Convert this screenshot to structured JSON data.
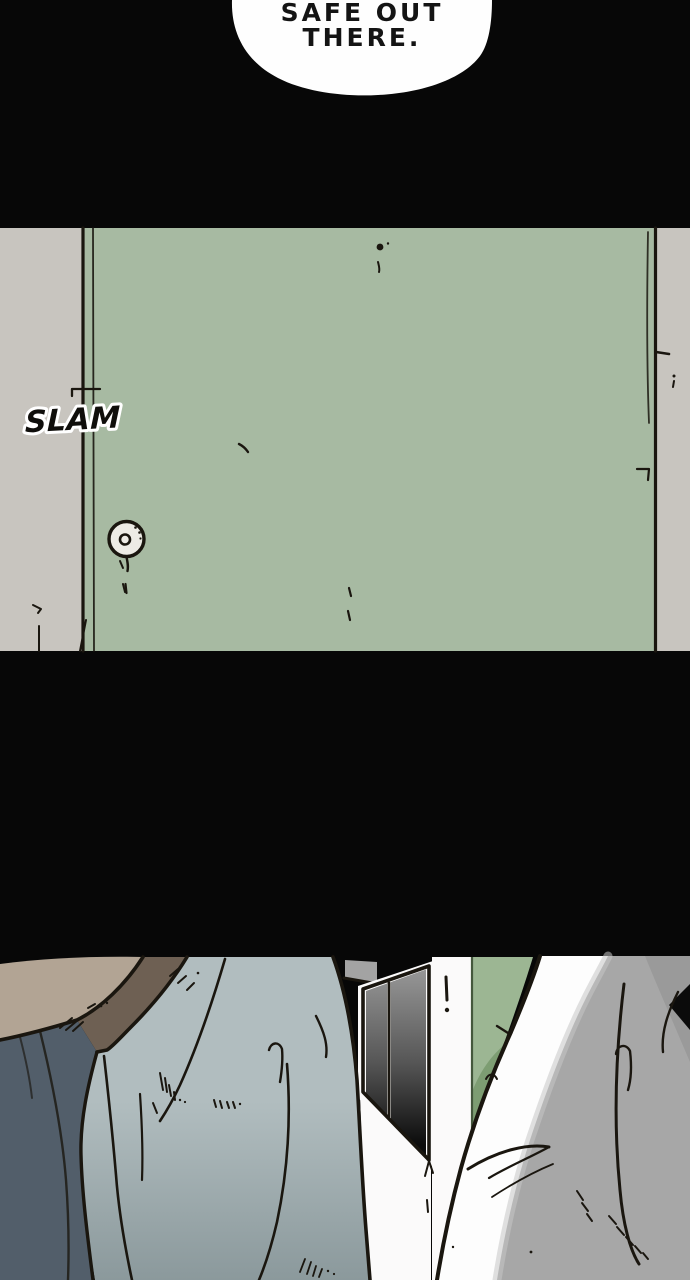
{
  "canvas": {
    "width": 690,
    "height": 1280,
    "background": "#070707"
  },
  "speech_bubble": {
    "lines": [
      "SAFE OUT",
      "THERE."
    ],
    "fill": "#fefefe",
    "text_color": "#141414"
  },
  "sfx": {
    "text": "SLAM",
    "fill": "#0f0e0b",
    "outline_color": "#ffffff"
  },
  "door_panel": {
    "wall_color": "#c8c5bf",
    "door_color": "#a7baa2",
    "door_edge_color": "#3c4a38",
    "knob_color": "#edebe5",
    "ink_color": "#1a160f"
  },
  "scene": {
    "colors": {
      "head_skin": "#b2a494",
      "hair_brown": "#6e6053",
      "shirt_dark": "#525e6a",
      "jacket_light": "#b1bdbf",
      "jacket_shade": "#8b999c",
      "wall_gray": "#a3a3a3",
      "frame_white": "#fbfafa",
      "window_top": "#9a9a9a",
      "window_mid": "#565656",
      "window_bottom": "#0c0c0c",
      "door_green": "#9cb693",
      "door_green_shade": "#7a9a6f",
      "door_green_edge": "#44573c",
      "shirt_white": "#fdfdfd",
      "shadow_gray": "#a7a7a7",
      "shadow_soft": "#c6c6c6",
      "shadow_deep": "#989898",
      "ink": "#141109"
    }
  }
}
